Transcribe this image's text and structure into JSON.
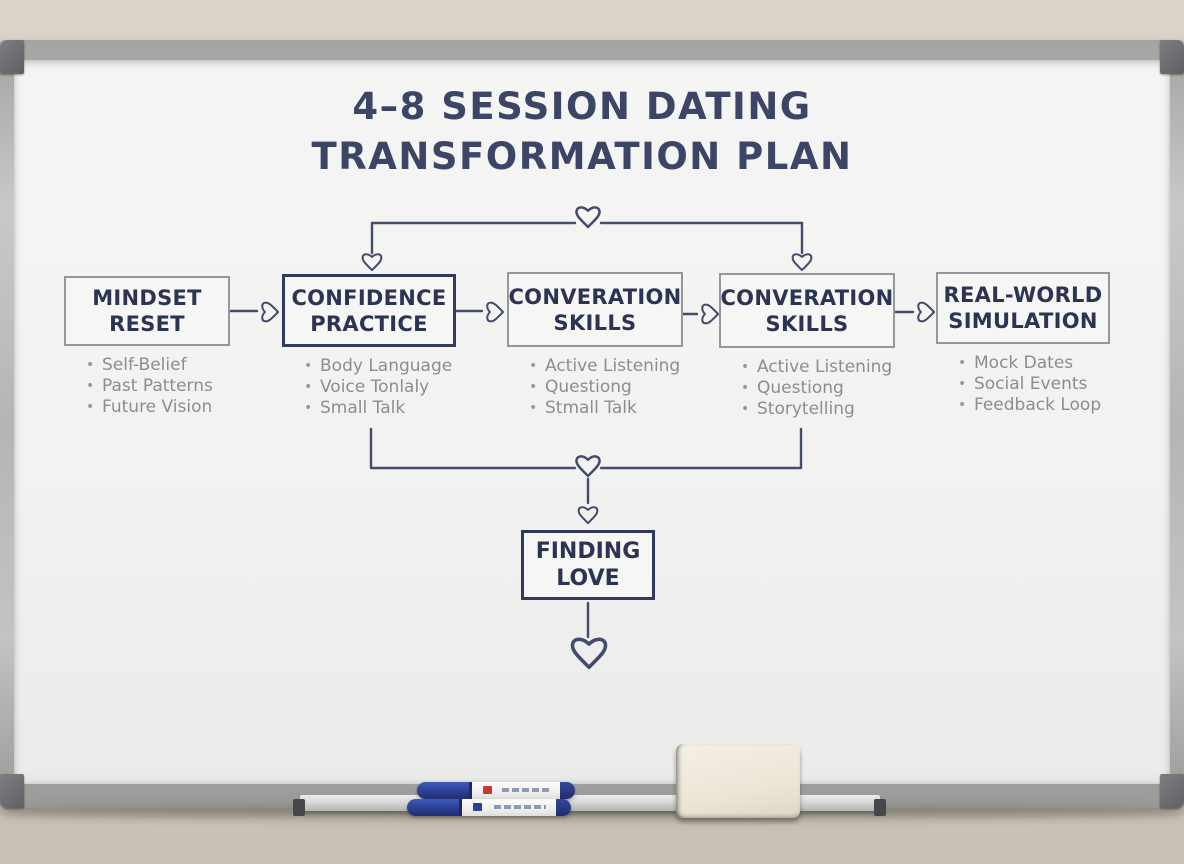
{
  "board": {
    "title_line1": "4–8 SESSION DATING",
    "title_line2": "TRANSFORMATION PLAN"
  },
  "stages": [
    {
      "title": "MINDSET RESET",
      "bullets": [
        "Self-Belief",
        "Past Patterns",
        "Future Vision"
      ]
    },
    {
      "title": "CONFIDENCE PRACTICE",
      "bullets": [
        "Body Language",
        "Voice Tonlaly",
        "Small Talk"
      ]
    },
    {
      "title": "CONVERATION SKILLS",
      "bullets": [
        "Active Listening",
        "Questiong",
        "Stmall Talk"
      ]
    },
    {
      "title": "CONVERATION SKILLS",
      "bullets": [
        "Active Listening",
        "Questiong",
        "Storytelling"
      ]
    },
    {
      "title": "REAL-WORLD SIMULATION",
      "bullets": [
        "Mock Dates",
        "Social Events",
        "Feedback Loop"
      ]
    }
  ],
  "final_stage": {
    "title": "FINDING LOVE"
  },
  "colors": {
    "ink_navy": "#3d4566",
    "box_title": "#2b3453",
    "bullet_text": "#8e8d8b",
    "gray_box_border": "#94979b",
    "navy_box_border": "#303b5f",
    "connector_ink": "#434c6d",
    "marker_blue": "#2b3f93",
    "wall_beige": "#d7d0c4",
    "frame_aluminum": "#b4b6b4"
  },
  "objects": {
    "marker_1": "blue dry-erase marker",
    "marker_2": "blue dry-erase marker",
    "eraser": "whiteboard eraser"
  }
}
